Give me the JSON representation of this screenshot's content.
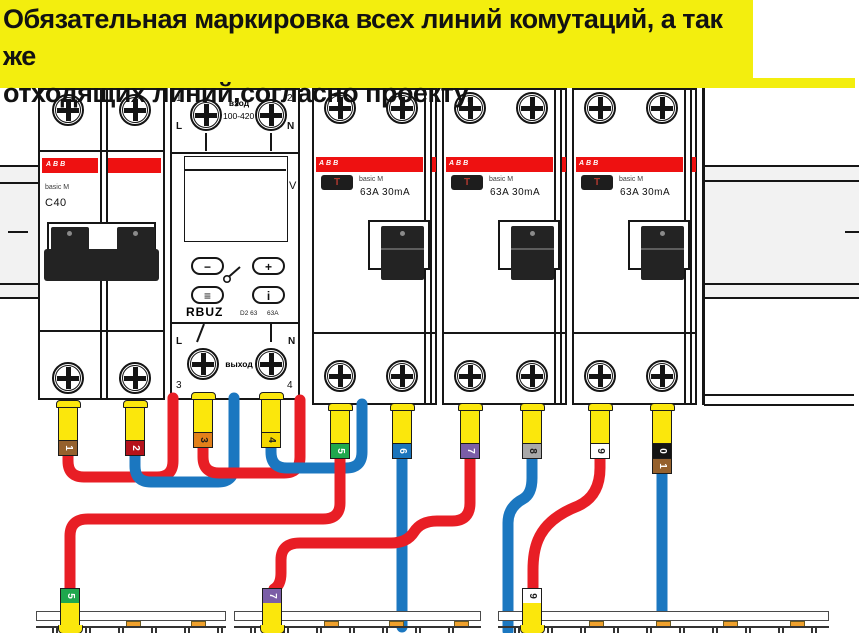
{
  "banner": {
    "line1": "Обязательная маркировка всех линий комутаций, а так же",
    "line2": "отходящих линий,согласно проекту.",
    "bg": "#f3ee0e"
  },
  "colors": {
    "wire_red": "#e81e25",
    "wire_blue": "#1b77c0",
    "stripe_red": "#ee1111",
    "marker_yellow": "#fbe70c"
  },
  "breaker": {
    "brand": "ABB",
    "series": "basic M",
    "rating": "C40"
  },
  "rbuz": {
    "corner_tl": "1",
    "corner_tr": "2",
    "corner_bl": "3",
    "corner_br": "4",
    "l_top": "L",
    "n_top": "N",
    "l_bot": "L",
    "n_bot": "N",
    "input_label": "вход",
    "input_range": "~ 100-420 В",
    "unit": "V",
    "btn_minus": "−",
    "btn_plus": "+",
    "btn_menu": "≡",
    "btn_info": "i",
    "model": "RBUZ",
    "type_code": "D2 63",
    "amp_code": "63A",
    "output_label": "выход"
  },
  "rcds": [
    {
      "brand": "ABB",
      "test": "T",
      "series": "basic M",
      "rating": "63A  30mA"
    },
    {
      "brand": "ABB",
      "test": "T",
      "series": "basic M",
      "rating": "63A  30mA"
    },
    {
      "brand": "ABB",
      "test": "T",
      "series": "basic M",
      "rating": "63A  30mA"
    }
  ],
  "markers_top": [
    {
      "label": "1",
      "cap": "#95612d",
      "text": "#fff",
      "x": 68,
      "top": 400
    },
    {
      "label": "2",
      "cap": "#b5121b",
      "text": "#fff",
      "x": 135,
      "top": 400
    },
    {
      "label": "3",
      "cap": "#e2801a",
      "text": "#1c1c1c",
      "x": 203,
      "top": 392
    },
    {
      "label": "4",
      "cap": "#f5d800",
      "text": "#1c1c1c",
      "x": 271,
      "top": 392
    },
    {
      "label": "5",
      "cap": "#1fa84d",
      "text": "#fff",
      "x": 340,
      "top": 403
    },
    {
      "label": "6",
      "cap": "#1b75bc",
      "text": "#fff",
      "x": 402,
      "top": 403
    },
    {
      "label": "7",
      "cap": "#7b5ea7",
      "text": "#fff",
      "x": 470,
      "top": 403
    },
    {
      "label": "8",
      "cap": "#a8a8a8",
      "text": "#1c1c1c",
      "x": 532,
      "top": 403
    },
    {
      "label": "9",
      "cap": "#ffffff",
      "text": "#1c1c1c",
      "x": 600,
      "top": 403
    },
    {
      "label": "10",
      "cap2": [
        {
          "d": "0",
          "bg": "#141414",
          "fg": "#fff"
        },
        {
          "d": "1",
          "bg": "#95612d",
          "fg": "#fff"
        }
      ],
      "x": 662,
      "top": 403
    }
  ],
  "markers_bottom": [
    {
      "label": "5",
      "cap": "#1fa84d",
      "text": "#fff",
      "x": 70,
      "top": 588
    },
    {
      "label": "7",
      "cap": "#7b5ea7",
      "text": "#fff",
      "x": 272,
      "top": 588
    },
    {
      "label": "9",
      "cap": "#ffffff",
      "text": "#1c1c1c",
      "x": 532,
      "top": 588
    }
  ],
  "wires": [
    {
      "id": "wire-1-to-rbuz-l",
      "color": "#e81e25",
      "path": "M 68 446 V 461 Q 68 477 84 477 H 157 Q 173 477 173 461 V 398"
    },
    {
      "id": "wire-2-to-rbuz-n",
      "color": "#1b77c0",
      "path": "M 135 446 V 466 Q 135 482 151 482 H 218 Q 234 482 234 466 V 398"
    },
    {
      "id": "wire-3-to-rcd1",
      "color": "#e81e25",
      "path": "M 203 436 V 457 Q 203 473 219 473 H 284 Q 300 473 300 457 V 400"
    },
    {
      "id": "wire-4-to-rcd1",
      "color": "#1b77c0",
      "path": "M 271 436 V 452 Q 271 468 287 468 H 346 Q 362 468 362 452 V 404"
    },
    {
      "id": "wire-5-to-left-bus",
      "color": "#e81e25",
      "path": "M 340 410 V 503 Q 340 519 323 519 H 88 Q 70 519 70 536 V 592"
    },
    {
      "id": "wire-6-to-mid-bus",
      "color": "#1b77c0",
      "path": "M 402 410 V 627"
    },
    {
      "id": "wire-7-to-mid-bus",
      "color": "#e81e25",
      "path": "M 470 410 V 503 Q 470 521 452 521 H 437 Q 421 521 414 532 Q 407 543 391 543 H 300 Q 281 543 281 560 V 573 Q 281 585 274 589"
    },
    {
      "id": "wire-8-to-right-bus",
      "color": "#1b77c0",
      "path": "M 532 410 V 478 Q 532 494 523 499 Q 508 507 508 523 V 631"
    },
    {
      "id": "wire-9-to-right-bus",
      "color": "#e81e25",
      "path": "M 600 410 V 468 Q 600 496 578 506 Q 547 518 538 540 Q 533 552 533 570 V 592"
    },
    {
      "id": "wire-10-to-right-bus",
      "color": "#1b77c0",
      "path": "M 662 410 V 619"
    }
  ],
  "busbars": [
    {
      "x": 36,
      "w": 190,
      "pads": [
        126,
        191
      ]
    },
    {
      "x": 234,
      "w": 247,
      "pads": [
        324,
        389,
        454
      ]
    },
    {
      "x": 498,
      "w": 331,
      "pads": [
        589,
        656,
        723,
        790
      ]
    }
  ]
}
